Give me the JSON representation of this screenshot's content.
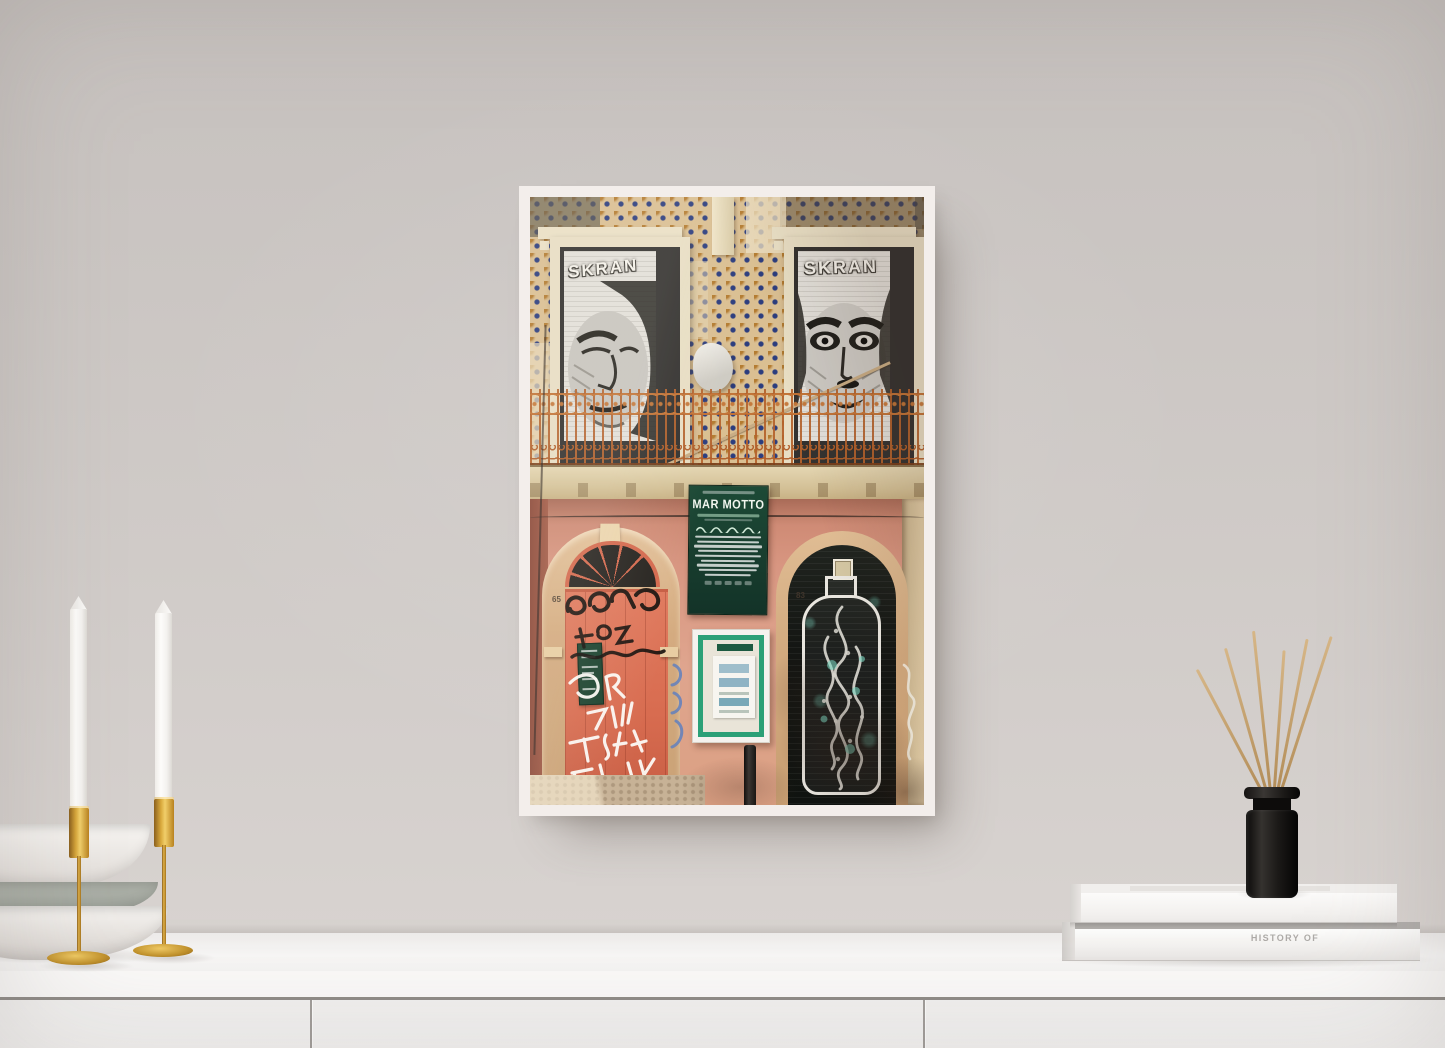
{
  "scene": {
    "type": "framed street-photography poster mockup in a bright interior",
    "wall_color": "#cdc8c5",
    "sideboard_color": "#f7f6f5",
    "frame_color": "#f3eeeb"
  },
  "poster": {
    "street_art": {
      "left_window_text": "SKRAN",
      "right_window_text": "SKRAN"
    },
    "sign": {
      "title": "MAR MOTTO",
      "bg_color": "#1d4a36"
    },
    "doors": {
      "left_number": "65",
      "right_number": "83",
      "left_door_color": "#dd7257"
    },
    "tiles_color": "#dabf92",
    "balcony_rust_color": "#b4622c",
    "teal_accent": "#76d4be"
  },
  "props": {
    "books": {
      "spine_title": "HISTORY OF"
    },
    "candles": {
      "count": 2,
      "holder_color": "#d9a93c",
      "candle_color": "#fdfcfa"
    },
    "diffuser": {
      "reed_count": 6,
      "bottle_color": "#141210"
    },
    "bowls": {
      "count": 3,
      "colors": [
        "#f7f5f2",
        "#a6aaa2",
        "#f6f4f1"
      ]
    }
  }
}
